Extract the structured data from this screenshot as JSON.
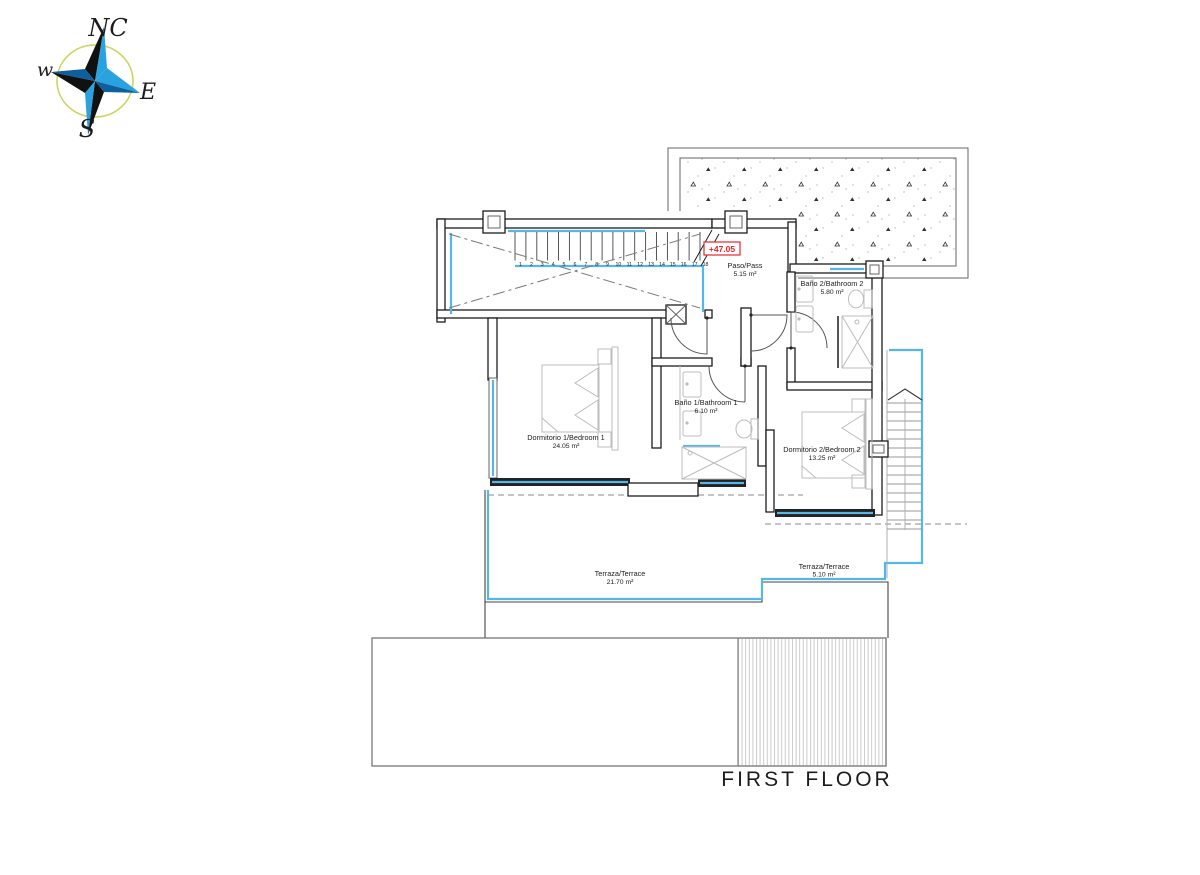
{
  "drawing_title": "FIRST FLOOR",
  "compass": {
    "north_label": "NC",
    "east_label": "E",
    "south_label": "S",
    "west_label": "w"
  },
  "level_marker": {
    "value": "+47.05"
  },
  "rooms": {
    "paso": {
      "name": "Paso/Pass",
      "area": "5.15 m²"
    },
    "bath2": {
      "name": "Baño 2/Bathroom 2",
      "area": "5.80 m²"
    },
    "bed1": {
      "name": "Dormitorio 1/Bedroom 1",
      "area": "24.05 m²"
    },
    "bath1": {
      "name": "Baño 1/Bathroom 1",
      "area": "6.10 m²"
    },
    "bed2": {
      "name": "Dormitorio 2/Bedroom 2",
      "area": "13.25 m²"
    },
    "terrace1": {
      "name": "Terraza/Terrace",
      "area": "21.70 m²"
    },
    "terrace2": {
      "name": "Terraza/Terrace",
      "area": "5.10 m²"
    }
  },
  "stairs": {
    "tread_numbers": [
      "1",
      "2",
      "3",
      "4",
      "5",
      "6",
      "7",
      "8",
      "9",
      "10",
      "11",
      "12",
      "13",
      "14",
      "15",
      "16",
      "17",
      "18"
    ]
  },
  "colors": {
    "glazing_cyan": "#55b7e8",
    "marker_red": "#e8242a",
    "wall_black": "#1c1c1c",
    "furniture_gray": "#bcbcbc",
    "compass_light_blue": "#2ba2e0",
    "compass_dark_blue": "#0d5f9e",
    "compass_ring_yellow": "#ccd45c"
  }
}
